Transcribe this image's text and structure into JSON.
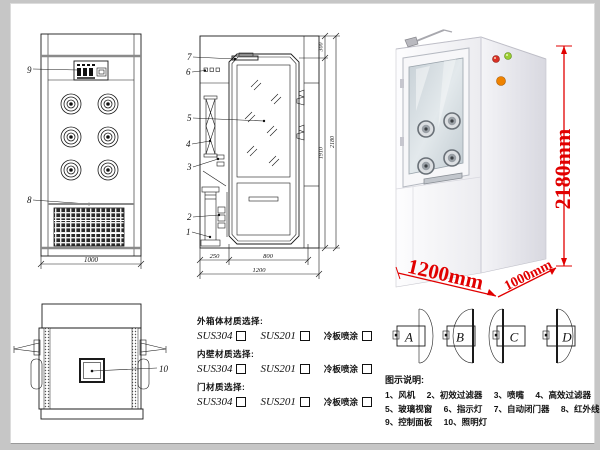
{
  "drawings": {
    "front_view": {
      "callout_control_panel": "9",
      "callout_grille": "8",
      "dim_width": "1000"
    },
    "side_view": {
      "callouts": [
        "7",
        "6",
        "5",
        "4",
        "3",
        "2",
        "1"
      ],
      "dim_top": "300",
      "dim_door_height": "1910",
      "dim_total_height": "2180",
      "dim_step": "250",
      "dim_door_width": "800",
      "dim_total_depth": "1200"
    },
    "top_view": {
      "callout_lamp": "10"
    }
  },
  "photo": {
    "dim_height": "2180mm",
    "dim_width": "1200mm",
    "dim_depth": "1000mm"
  },
  "materials": {
    "sections": [
      {
        "title": "外箱体材质选择:",
        "options": [
          "SUS304",
          "SUS201",
          "冷板喷涂"
        ]
      },
      {
        "title": "内壁材质选择:",
        "options": [
          "SUS304",
          "SUS201",
          "冷板喷涂"
        ]
      },
      {
        "title": "门材质选择:",
        "options": [
          "SUS304",
          "SUS201",
          "冷板喷涂"
        ]
      }
    ]
  },
  "door_options": [
    "A",
    "B",
    "C",
    "D"
  ],
  "legend": {
    "title": "图示说明:",
    "rows": [
      [
        "1、风机",
        "2、初效过滤器",
        "3、喷嘴",
        "4、高效过滤器"
      ],
      [
        "5、玻璃视窗",
        "6、指示灯",
        "7、自动闭门器",
        "8、红外线感应器"
      ],
      [
        "9、控制面板",
        "10、照明灯"
      ]
    ]
  }
}
